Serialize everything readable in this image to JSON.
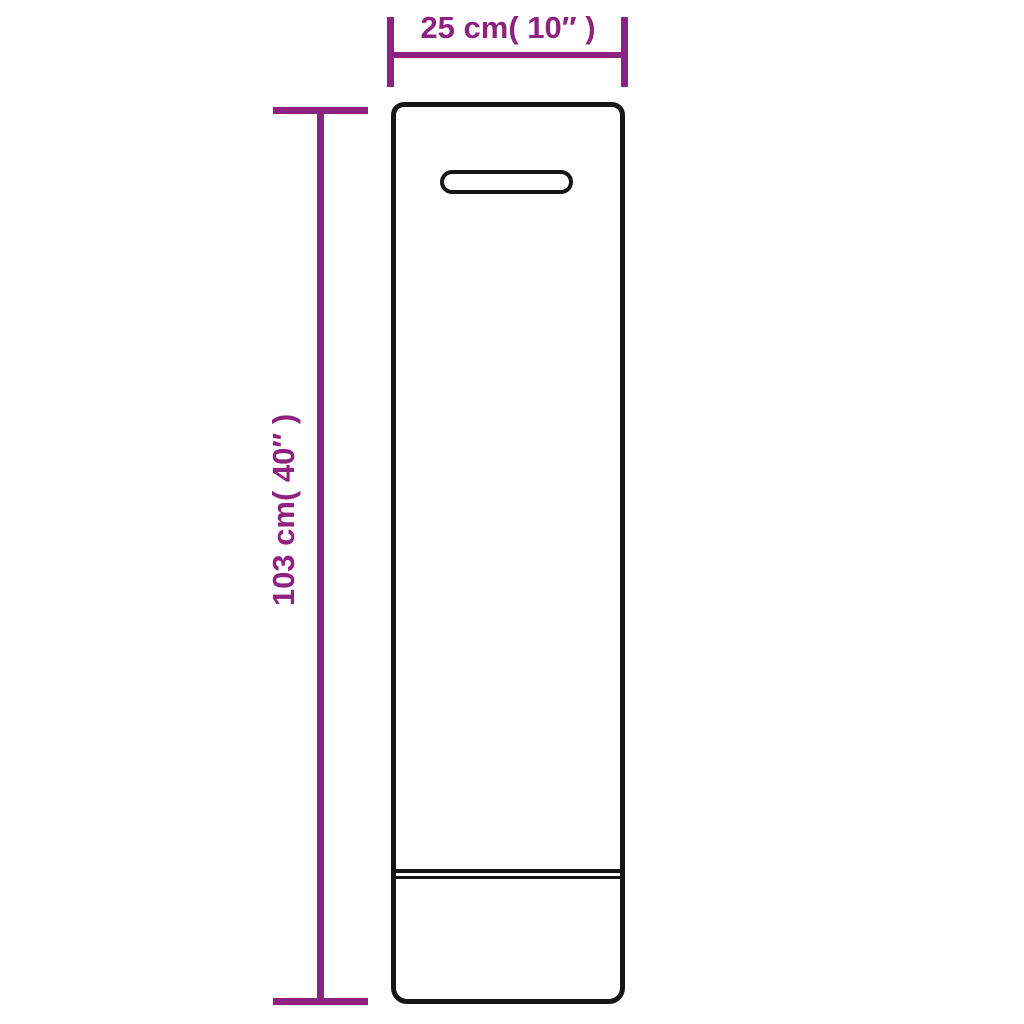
{
  "diagram": {
    "type": "product-dimension-diagram",
    "dimension_width": {
      "label": "25 cm( 10″ )",
      "value_cm": 25,
      "value_inches": 10
    },
    "dimension_height": {
      "label": "103 cm( 40″ )",
      "value_cm": 103,
      "value_inches": 40
    },
    "colors": {
      "dimension": "#8f2180",
      "outline": "#161616",
      "background": "#ffffff"
    }
  }
}
